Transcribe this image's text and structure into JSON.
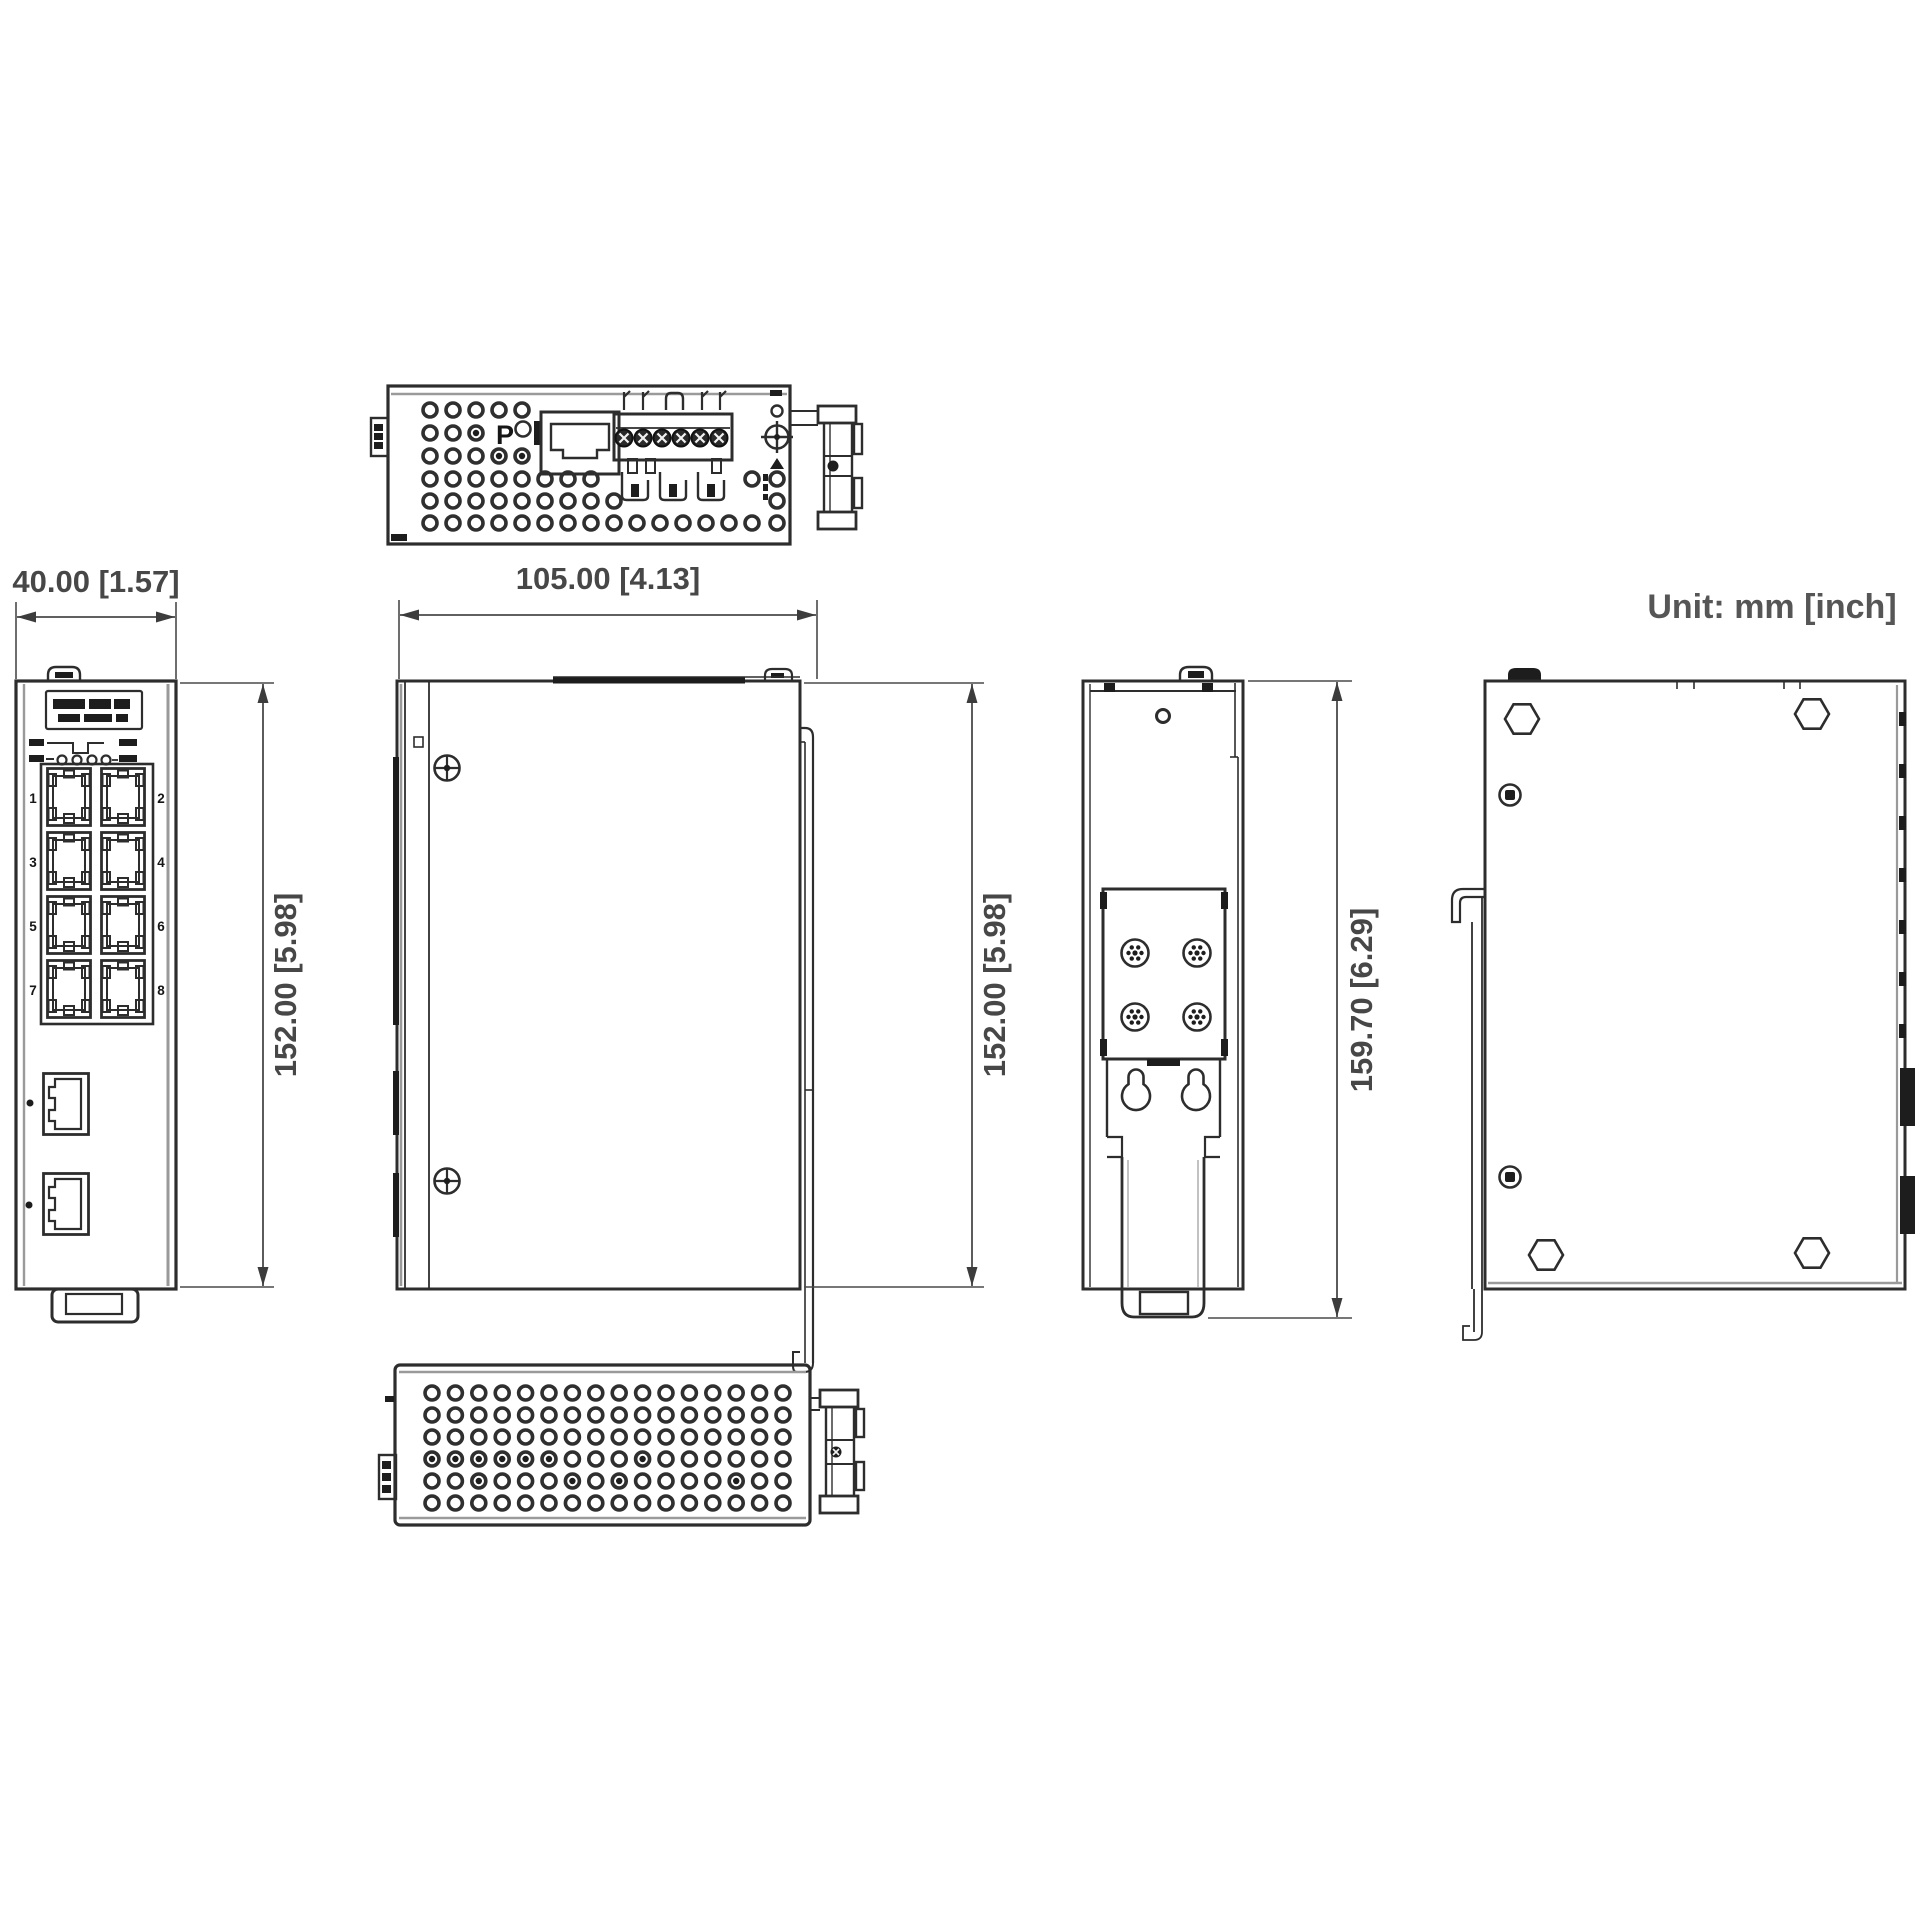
{
  "unit_note": "Unit: mm [inch]",
  "dimensions": {
    "front_width": "40.00 [1.57]",
    "depth": "105.00 [4.13]",
    "front_height": "152.00 [5.98]",
    "side_height": "152.00 [5.98]",
    "overall_height": "159.70 [6.29]"
  },
  "front_view": {
    "port_labels": [
      "1",
      "2",
      "3",
      "4",
      "5",
      "6",
      "7",
      "8"
    ]
  },
  "top_view": {
    "marking": "P"
  },
  "colors": {
    "line": "#2d2d2d",
    "dim_text": "#474747",
    "background": "#ffffff"
  }
}
